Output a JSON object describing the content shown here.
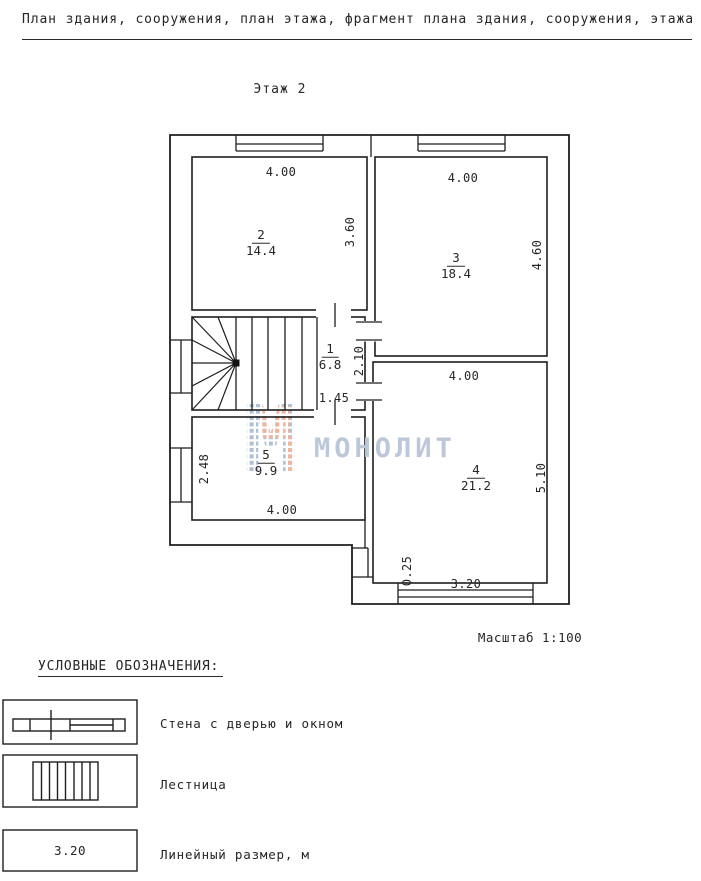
{
  "page": {
    "title": "План здания, сооружения, план этажа, фрагмент плана здания, сооружения, этажа",
    "floor_label": "Этаж 2",
    "scale_label": "Масштаб 1:100"
  },
  "watermark": {
    "text": "МОНОЛИТ",
    "logo": "monolit-m-logo",
    "color_blue": "#aebfd6",
    "color_orange": "#f2b49b"
  },
  "plan": {
    "rooms": [
      {
        "number": "2",
        "area": "14.4",
        "x": 261,
        "y": 243
      },
      {
        "number": "3",
        "area": "18.4",
        "x": 456,
        "y": 266
      },
      {
        "number": "1",
        "area": "6.8",
        "x": 330,
        "y": 357
      },
      {
        "number": "5",
        "area": "9.9",
        "x": 266,
        "y": 463
      },
      {
        "number": "4",
        "area": "21.2",
        "x": 476,
        "y": 478
      }
    ],
    "dimensions": [
      {
        "text": "4.00",
        "x": 281,
        "y": 172,
        "rot": 0
      },
      {
        "text": "3.60",
        "x": 350,
        "y": 232,
        "rot": -90
      },
      {
        "text": "4.00",
        "x": 463,
        "y": 178,
        "rot": 0
      },
      {
        "text": "4.60",
        "x": 537,
        "y": 255,
        "rot": -90
      },
      {
        "text": "2.10",
        "x": 359,
        "y": 361,
        "rot": -90
      },
      {
        "text": "1.45",
        "x": 334,
        "y": 398,
        "rot": 0
      },
      {
        "text": "2.48",
        "x": 204,
        "y": 469,
        "rot": -90
      },
      {
        "text": "4.00",
        "x": 282,
        "y": 510,
        "rot": 0
      },
      {
        "text": "4.00",
        "x": 464,
        "y": 376,
        "rot": 0
      },
      {
        "text": "5.10",
        "x": 541,
        "y": 478,
        "rot": -90
      },
      {
        "text": "0.25",
        "x": 407,
        "y": 571,
        "rot": -90
      },
      {
        "text": "3.20",
        "x": 466,
        "y": 584,
        "rot": 0
      }
    ]
  },
  "legend": {
    "heading": "УСЛОВНЫЕ ОБОЗНАЧЕНИЯ:",
    "items": [
      {
        "label": "Стена с дверью и окном",
        "symbol": "wall-door-window"
      },
      {
        "label": "Лестница",
        "symbol": "staircase"
      },
      {
        "label": "Линейный размер, м",
        "symbol": "linear-dimension",
        "sample": "3.20"
      }
    ]
  }
}
